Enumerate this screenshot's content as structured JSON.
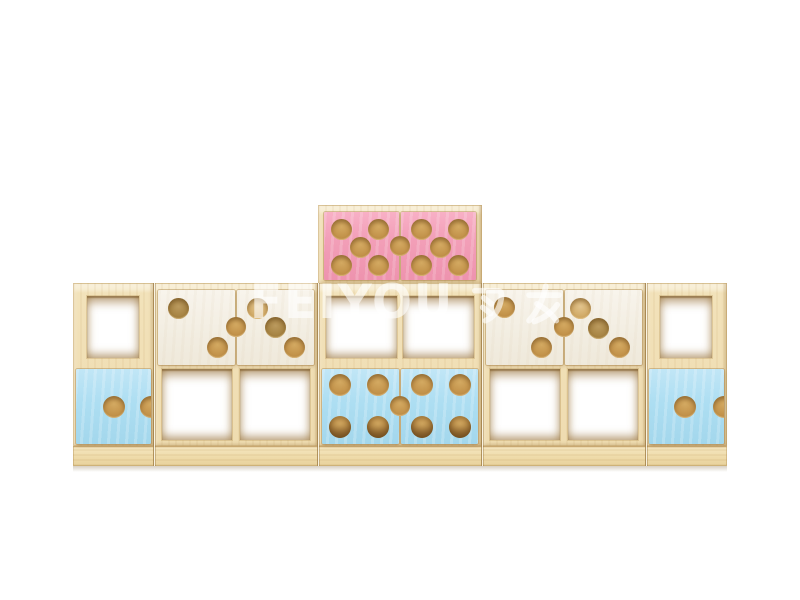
{
  "scene": {
    "description": "3D render of kids modular wooden storage cabinet combination on white background",
    "background": "#ffffff"
  },
  "watermark": {
    "text": "FEIYOU 飞友",
    "latin": "FEIYOU",
    "cjk": "飞友",
    "color": "#ffffff",
    "opacity": 0.62
  },
  "palette": {
    "wood_face": "#f2e2ba",
    "wood_top_highlight": "#faf2dc",
    "wood_edge": "#d9be8c",
    "plinth": "#eedaa8",
    "hole_wood": "#c3934b",
    "hole_dim": "#a3803f",
    "hole_light": "#cda45e",
    "door_pink": "#f29fb8",
    "door_blue": "#addef2",
    "door_white": "#f2ede1"
  },
  "furniture": {
    "body_top": 283,
    "body_bottom": 446,
    "plinth_bottom": 466,
    "left": 73,
    "width": 654,
    "junctions": [
      154,
      318,
      482,
      646
    ],
    "modules": [
      {
        "id": "left-cube",
        "x": 73,
        "w": 81,
        "openings": [
          {
            "x": 87,
            "y": 296,
            "w": 52,
            "h": 62
          }
        ],
        "doors": [
          {
            "color": "blue",
            "x": 76,
            "y": 369,
            "w": 75,
            "h": 75,
            "notch": true,
            "holes": [
              {
                "x": 50,
                "y": 50,
                "r": 11,
                "v": ""
              }
            ]
          }
        ],
        "handles": []
      },
      {
        "id": "white-double-left",
        "x": 154,
        "w": 164,
        "openings": [
          {
            "x": 162,
            "y": 369,
            "w": 70,
            "h": 71
          },
          {
            "x": 240,
            "y": 369,
            "w": 70,
            "h": 71
          }
        ],
        "doors": [
          {
            "color": "white",
            "x": 158,
            "y": 290,
            "w": 77,
            "h": 75,
            "holes": [
              {
                "x": 26,
                "y": 24,
                "r": 10.5,
                "v": "dim"
              },
              {
                "x": 77,
                "y": 76,
                "r": 10.5,
                "v": ""
              }
            ]
          },
          {
            "color": "white",
            "x": 237,
            "y": 290,
            "w": 77,
            "h": 75,
            "holes": [
              {
                "x": 26,
                "y": 24,
                "r": 10.5,
                "v": "light"
              },
              {
                "x": 50,
                "y": 50,
                "r": 10.5,
                "v": "dim"
              },
              {
                "x": 75,
                "y": 76,
                "r": 10.5,
                "v": ""
              }
            ]
          }
        ],
        "handles": [
          {
            "cx": 236,
            "cy": 327,
            "r": 10
          }
        ]
      },
      {
        "id": "center-tower",
        "x": 318,
        "w": 164,
        "crown": {
          "y": 205,
          "h": 79
        },
        "openings": [
          {
            "x": 326,
            "y": 296,
            "w": 71,
            "h": 62
          },
          {
            "x": 403,
            "y": 296,
            "w": 71,
            "h": 62
          }
        ],
        "doors": [
          {
            "color": "pink",
            "x": 324,
            "y": 212,
            "w": 75,
            "h": 68,
            "holes": [
              {
                "x": 23,
                "y": 25,
                "r": 10.5,
                "v": ""
              },
              {
                "x": 73,
                "y": 25,
                "r": 10.5,
                "v": ""
              },
              {
                "x": 48,
                "y": 52,
                "r": 10.5,
                "v": ""
              },
              {
                "x": 23,
                "y": 79,
                "r": 10.5,
                "v": ""
              },
              {
                "x": 73,
                "y": 79,
                "r": 10.5,
                "v": ""
              }
            ]
          },
          {
            "color": "pink",
            "x": 401,
            "y": 212,
            "w": 75,
            "h": 68,
            "holes": [
              {
                "x": 27,
                "y": 25,
                "r": 10.5,
                "v": ""
              },
              {
                "x": 77,
                "y": 25,
                "r": 10.5,
                "v": ""
              },
              {
                "x": 52,
                "y": 52,
                "r": 10.5,
                "v": ""
              },
              {
                "x": 27,
                "y": 79,
                "r": 10.5,
                "v": ""
              },
              {
                "x": 77,
                "y": 79,
                "r": 10.5,
                "v": ""
              }
            ]
          },
          {
            "color": "blue",
            "x": 322,
            "y": 369,
            "w": 77,
            "h": 75,
            "holes": [
              {
                "x": 23,
                "y": 21,
                "r": 11,
                "v": ""
              },
              {
                "x": 73,
                "y": 21,
                "r": 11,
                "v": ""
              },
              {
                "x": 23,
                "y": 77,
                "r": 11,
                "v": "deep"
              },
              {
                "x": 73,
                "y": 77,
                "r": 11,
                "v": "deep"
              }
            ]
          },
          {
            "color": "blue",
            "x": 401,
            "y": 369,
            "w": 77,
            "h": 75,
            "holes": [
              {
                "x": 27,
                "y": 21,
                "r": 11,
                "v": ""
              },
              {
                "x": 77,
                "y": 21,
                "r": 11,
                "v": ""
              },
              {
                "x": 27,
                "y": 77,
                "r": 11,
                "v": "deep"
              },
              {
                "x": 77,
                "y": 77,
                "r": 11,
                "v": "deep"
              }
            ]
          }
        ],
        "handles": [
          {
            "cx": 400,
            "cy": 246,
            "r": 10
          },
          {
            "cx": 400,
            "cy": 406,
            "r": 10
          }
        ]
      },
      {
        "id": "white-double-right",
        "x": 482,
        "w": 164,
        "openings": [
          {
            "x": 490,
            "y": 369,
            "w": 70,
            "h": 71
          },
          {
            "x": 568,
            "y": 369,
            "w": 70,
            "h": 71
          }
        ],
        "doors": [
          {
            "color": "white",
            "x": 486,
            "y": 290,
            "w": 77,
            "h": 75,
            "holes": [
              {
                "x": 24,
                "y": 23,
                "r": 10.5,
                "v": ""
              },
              {
                "x": 72,
                "y": 77,
                "r": 10.5,
                "v": ""
              }
            ]
          },
          {
            "color": "white",
            "x": 565,
            "y": 290,
            "w": 77,
            "h": 75,
            "holes": [
              {
                "x": 20,
                "y": 24,
                "r": 10.5,
                "v": "light"
              },
              {
                "x": 44,
                "y": 51,
                "r": 10.5,
                "v": "dim"
              },
              {
                "x": 71,
                "y": 76,
                "r": 10.5,
                "v": ""
              }
            ]
          }
        ],
        "handles": [
          {
            "cx": 564,
            "cy": 327,
            "r": 10
          }
        ]
      },
      {
        "id": "right-cube",
        "x": 646,
        "w": 81,
        "openings": [
          {
            "x": 660,
            "y": 296,
            "w": 52,
            "h": 62
          }
        ],
        "doors": [
          {
            "color": "blue",
            "x": 649,
            "y": 369,
            "w": 75,
            "h": 75,
            "notch": true,
            "holes": [
              {
                "x": 48,
                "y": 50,
                "r": 11,
                "v": ""
              }
            ]
          }
        ],
        "handles": []
      }
    ]
  }
}
